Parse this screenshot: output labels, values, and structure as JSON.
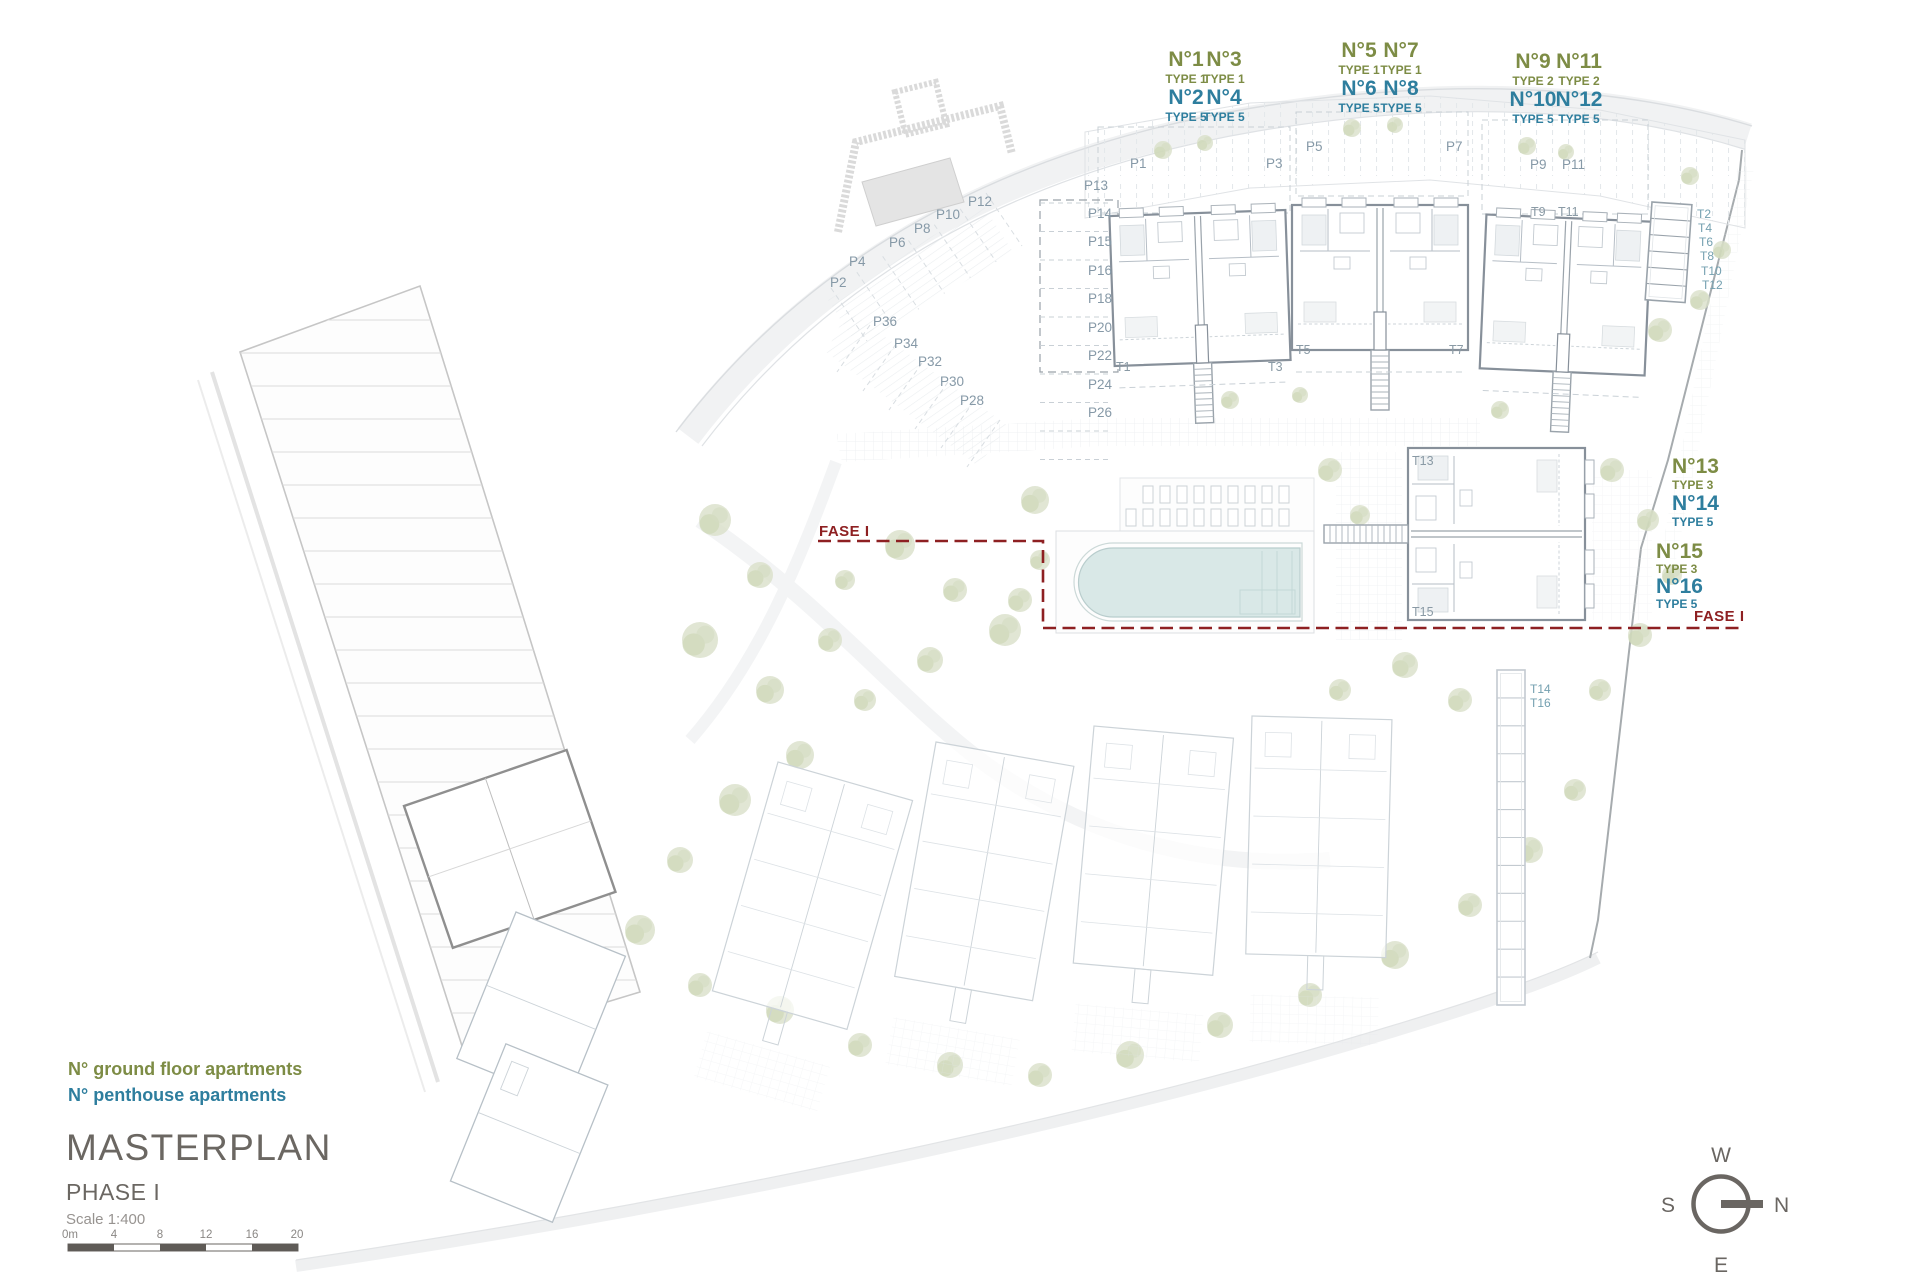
{
  "title_block": {
    "title": "MASTERPLAN",
    "phase": "PHASE I",
    "scale": "Scale 1:400",
    "scale_bar_labels": [
      "0m",
      "4",
      "8",
      "12",
      "16",
      "20"
    ]
  },
  "legend": {
    "ground_floor": "N° ground floor apartments",
    "penthouse": "N° penthouse apartments"
  },
  "compass": {
    "top": "W",
    "right": "N",
    "bottom": "E",
    "left": "S"
  },
  "phase_boundary": {
    "label_left": "FASE I",
    "label_right": "FASE I"
  },
  "apartments": {
    "groups": [
      {
        "name": "building-1",
        "units": [
          {
            "no": "N°1",
            "type": "TYPE 1"
          },
          {
            "no": "N°3",
            "type": "TYPE 1"
          },
          {
            "no": "N°2",
            "type": "TYPE 5"
          },
          {
            "no": "N°4",
            "type": "TYPE 5"
          }
        ]
      },
      {
        "name": "building-2",
        "units": [
          {
            "no": "N°5",
            "type": "TYPE 1"
          },
          {
            "no": "N°7",
            "type": "TYPE 1"
          },
          {
            "no": "N°6",
            "type": "TYPE 5"
          },
          {
            "no": "N°8",
            "type": "TYPE 5"
          }
        ]
      },
      {
        "name": "building-3",
        "units": [
          {
            "no": "N°9",
            "type": "TYPE 2"
          },
          {
            "no": "N°11",
            "type": "TYPE 2"
          },
          {
            "no": "N°10",
            "type": "TYPE 5"
          },
          {
            "no": "N°12",
            "type": "TYPE 5"
          }
        ]
      },
      {
        "name": "building-4-upper",
        "units": [
          {
            "no": "N°13",
            "type": "TYPE 3"
          },
          {
            "no": "N°14",
            "type": "TYPE 5"
          }
        ]
      },
      {
        "name": "building-4-lower",
        "units": [
          {
            "no": "N°15",
            "type": "TYPE 3"
          },
          {
            "no": "N°16",
            "type": "TYPE 5"
          }
        ]
      }
    ]
  },
  "plan": {
    "parking_labels": {
      "top_row": [
        "P1",
        "P3",
        "P5",
        "P7",
        "P9",
        "P11"
      ],
      "left_column": [
        "P13",
        "P14",
        "P15",
        "P16",
        "P18",
        "P20",
        "P22",
        "P24",
        "P26"
      ],
      "upper_diagonal": [
        "P12",
        "P10",
        "P8",
        "P6",
        "P4",
        "P2"
      ],
      "lower_diagonal": [
        "P36",
        "P34",
        "P32",
        "P30",
        "P28"
      ]
    },
    "stair_labels": {
      "t1": "T1",
      "t3": "T3",
      "t5": "T5",
      "t7": "T7",
      "t9": "T9",
      "t11": "T11",
      "t13": "T13",
      "t15": "T15"
    },
    "storage_labels": {
      "top_right": [
        "T2",
        "T4",
        "T6",
        "T8",
        "T10",
        "T12"
      ],
      "bottom_right": [
        "T14",
        "T16"
      ]
    }
  },
  "colors": {
    "ground_floor_label": "#7d8c45",
    "penthouse_label": "#2e7e9e",
    "phase_boundary": "#8e2022",
    "title_text": "#6b6762",
    "plan_label": "#8699a7",
    "pool_water": "#d9e8e7"
  }
}
